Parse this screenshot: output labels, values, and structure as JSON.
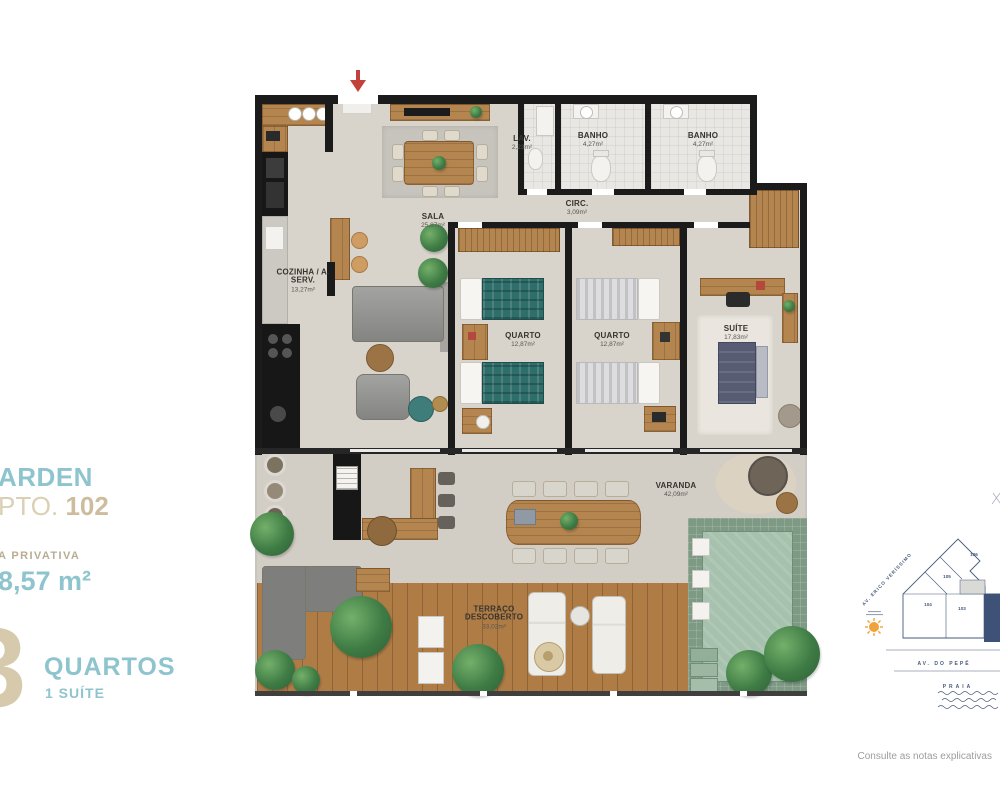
{
  "info_panel": {
    "project_fragment": "ARDEN",
    "unit_prefix": "PTO.",
    "unit_number": "102",
    "area_label": "A PRIVATIVA",
    "area_value": "8,57 m²",
    "bedrooms_count": "3",
    "bedrooms_label": "QUARTOS",
    "suite_label": "1 SUÍTE"
  },
  "rooms": {
    "cozinha": {
      "name": "COZINHA / A. SERV.",
      "area": "13,27m²"
    },
    "sala": {
      "name": "SALA",
      "area": "25,87m²"
    },
    "lav": {
      "name": "LAV.",
      "area": "2,23m²"
    },
    "banho1": {
      "name": "BANHO",
      "area": "4,27m²"
    },
    "banho2": {
      "name": "BANHO",
      "area": "4,27m²"
    },
    "circ": {
      "name": "CIRC.",
      "area": "3,09m²"
    },
    "quarto1": {
      "name": "QUARTO",
      "area": "12,87m²"
    },
    "quarto2": {
      "name": "QUARTO",
      "area": "12,87m²"
    },
    "suite": {
      "name": "SUÍTE",
      "area": "17,83m²"
    },
    "varanda": {
      "name": "VARANDA",
      "area": "42,09m²"
    },
    "terraco": {
      "name": "TERRAÇO DESCOBERTO",
      "area": "33,02m²"
    }
  },
  "site_map": {
    "street_diagonal": "AV. ERICO VERÍSSIMO",
    "street_horizontal": "AV. DO PEPÊ",
    "beach": "PRAIA",
    "units": [
      "106",
      "105",
      "104",
      "103"
    ]
  },
  "footer_note": "Consulte as notas explicativas",
  "colors": {
    "teal": "#8ec4ce",
    "tan": "#cfc0a0",
    "wall": "#1b1b1b",
    "highlight_unit": "#3d5276",
    "entrance_arrow": "#c2413a",
    "pool_water": "#a6c2ae"
  }
}
